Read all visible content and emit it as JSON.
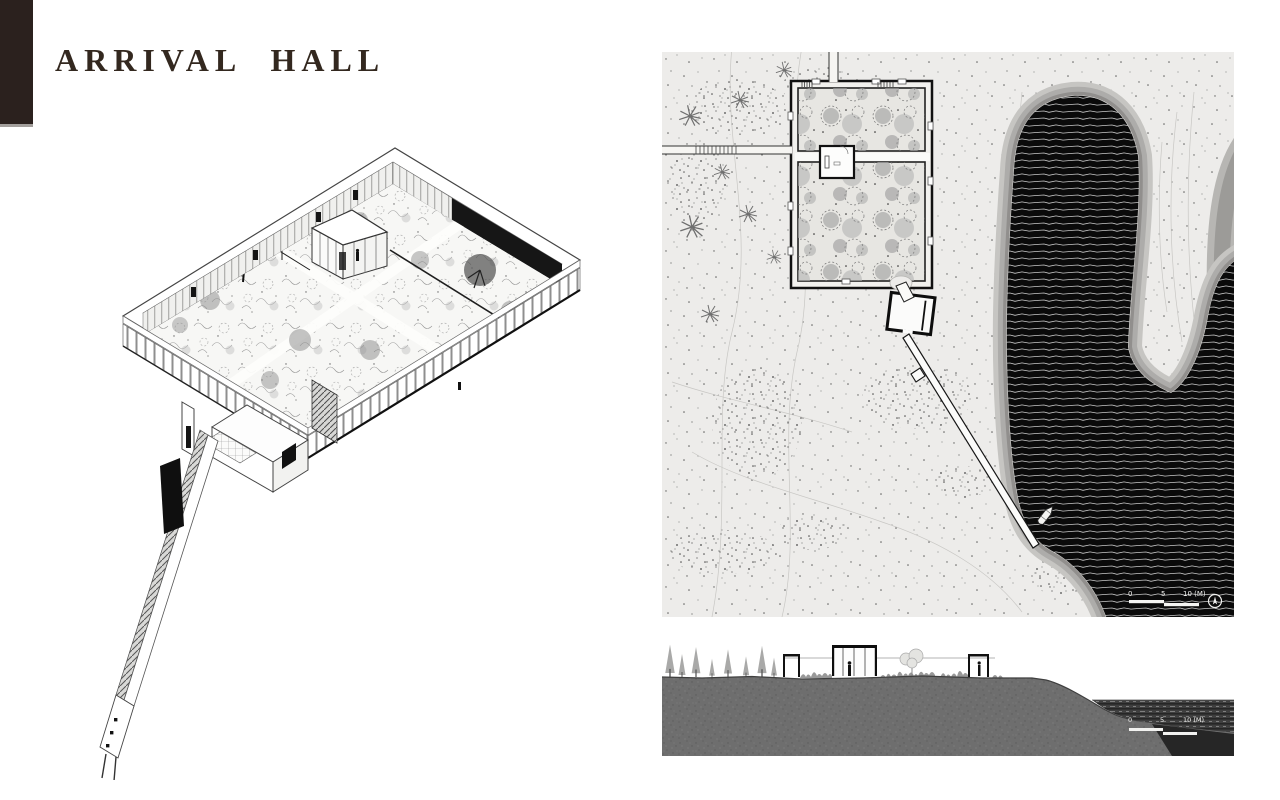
{
  "title": "ARRIVAL HALL",
  "scale_bars": {
    "site_plan_labels": [
      "0",
      "5",
      "10 (M)"
    ],
    "section_labels": [
      "0",
      "5",
      "10 (M)"
    ]
  },
  "icons": {
    "north_arrow": "north-arrow-icon"
  },
  "colors": {
    "accent_bar": "#2b211e",
    "title_text": "#33281f",
    "water": "#0a0a0a",
    "land": "#edecea",
    "shore_band_light": "#c6c5c2",
    "shore_band_mid": "#adacaa",
    "shore_band_dark": "#918f8d",
    "section_ground": "#6e6e6e"
  }
}
